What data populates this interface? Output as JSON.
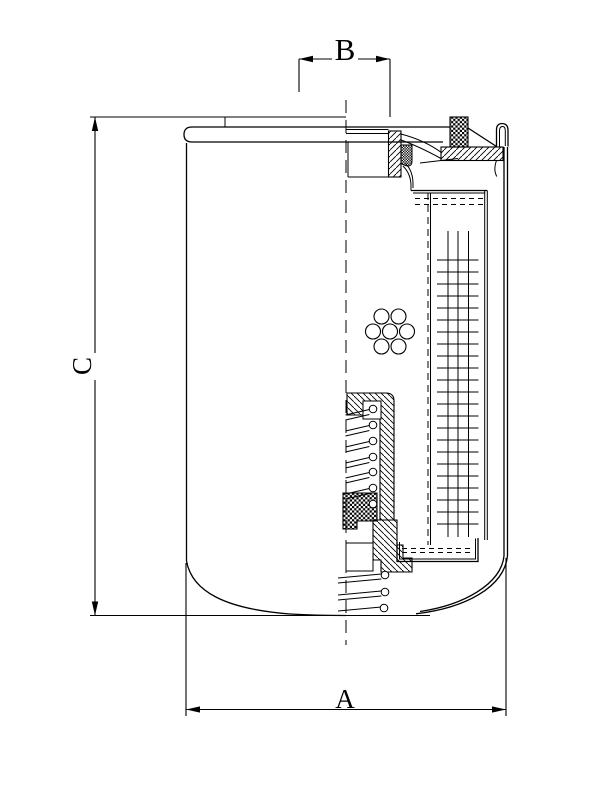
{
  "drawing": {
    "type": "technical-cross-section",
    "subject": "spin-on filter half-section drawing",
    "colors": {
      "line": "#000000",
      "background": "#ffffff"
    },
    "dimensions": {
      "a": {
        "label": "A",
        "orientation": "horizontal",
        "position": "bottom",
        "measures": "outer diameter of can"
      },
      "b": {
        "label": "B",
        "orientation": "horizontal",
        "position": "top",
        "measures": "thread diameter"
      },
      "c": {
        "label": "C",
        "orientation": "vertical",
        "position": "left",
        "measures": "overall height"
      }
    }
  }
}
